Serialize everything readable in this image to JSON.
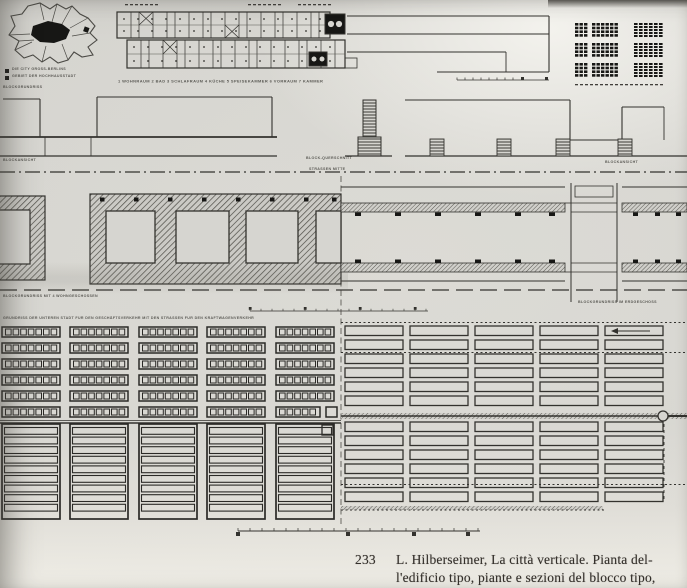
{
  "figure_caption": {
    "number": "233",
    "line1": "L. Hilberseimer, La città verticale. Pianta del-",
    "line2": "l'edificio tipo, piante e sezioni del blocco tipo,"
  },
  "drawing_labels": {
    "map_legend_1": "DIE CITY GROSS-BERLINS",
    "map_legend_2": "GEBIET DER HOCHHAUSSTADT",
    "plan_legend": "1 WOHNRAUM 2 BAD 3 SCHLAFRAUM 4 KÜCHE 5 SPEISEKAMMER 6 VORRAUM 7 KAMMER",
    "block_plan_top": "BLOCKGRUNDRISS",
    "block_elevation_left": "BLOCKANSICHT",
    "block_elevation_right": "BLOCKANSICHT",
    "block_cross_section": "BLOCK-QUERSCHNITT",
    "street_center": "STRASSEN MITTE",
    "block_plan_left": "BLOCKGRUNDRISS MIT 4 WOHNGESCHOSSEN",
    "block_plan_right": "BLOCKGRUNDRISS IM ERDGESCHOSS",
    "lower_city_plan": "GRUNDRISS DER UNTEREN STADT FÜR DEN GESCHÄFTSVERKEHR MIT DEN STRASSEN FÜR DEN KRAFTWAGENVERKEHR"
  },
  "colors": {
    "paper": "#d6d5d0",
    "ink": "#33322e",
    "ink_light": "#45443f",
    "black": "#171715"
  }
}
